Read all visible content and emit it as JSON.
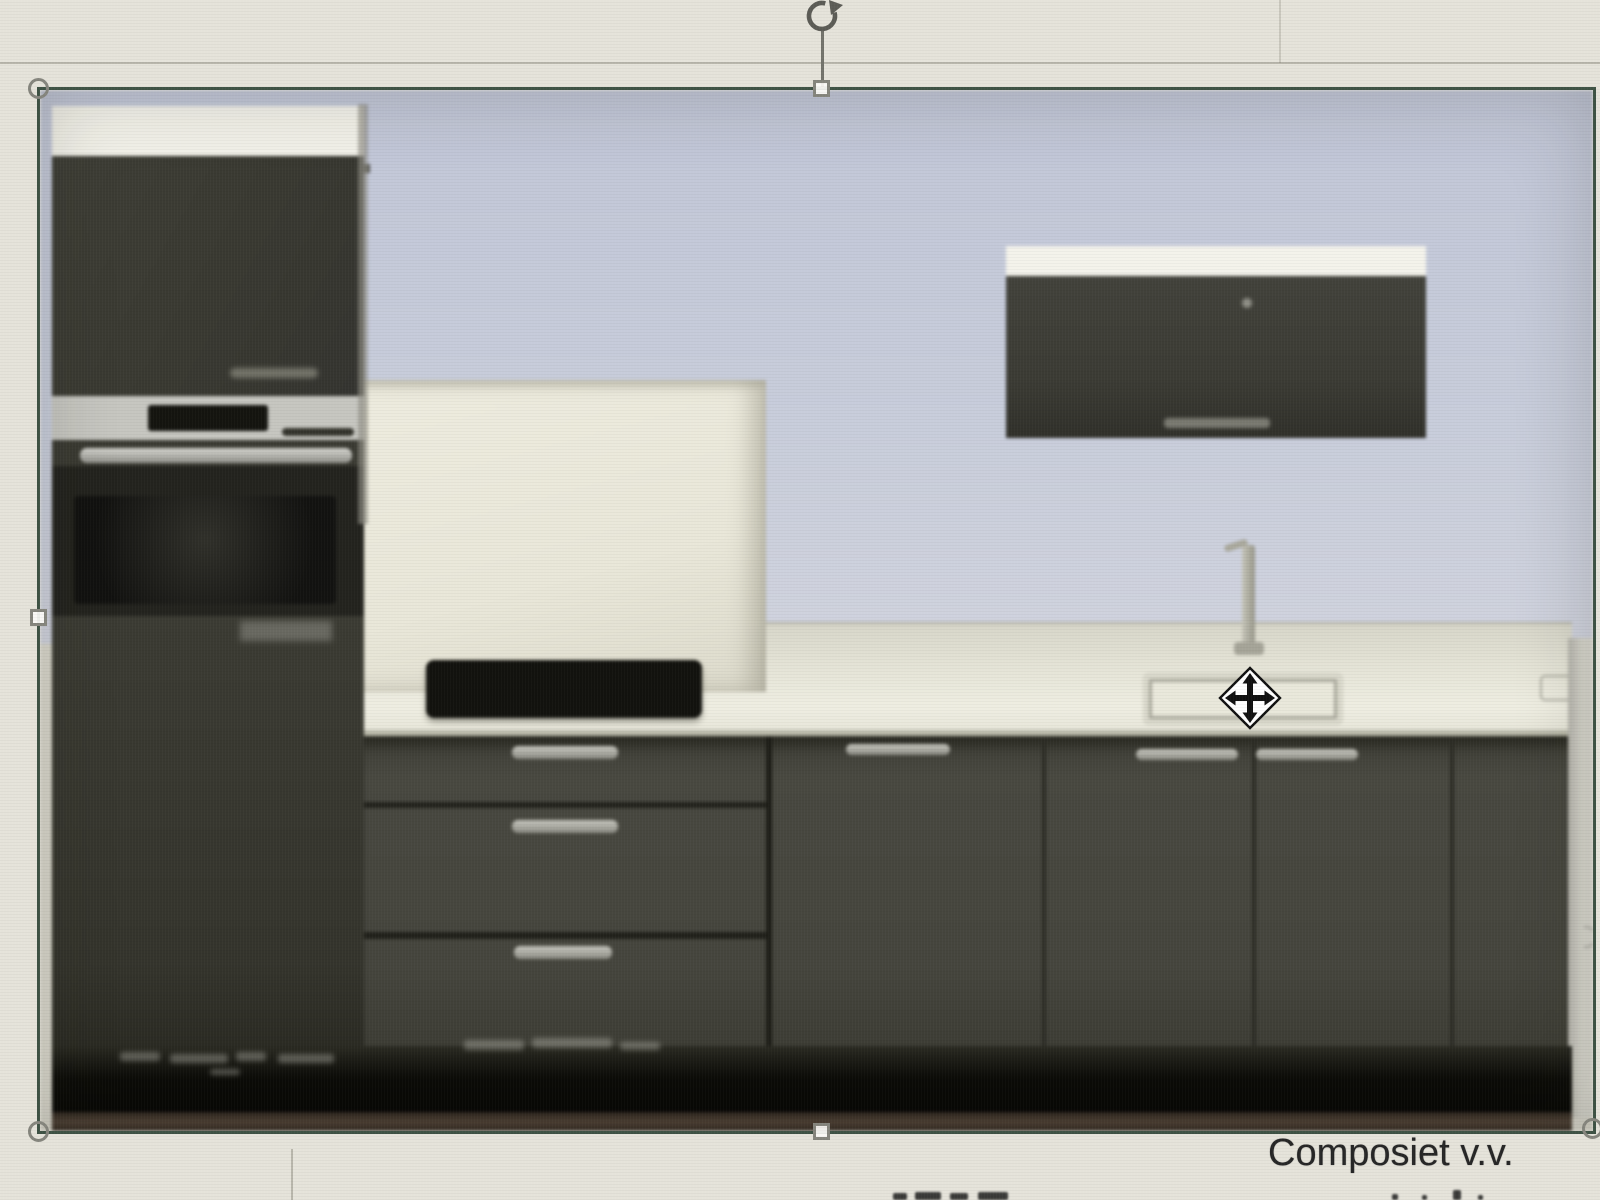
{
  "window": {
    "context": "presentation-editor slide area with a selected picture"
  },
  "slide": {
    "background_color": "#e5e3da",
    "caption_text": "Composiet v.v.",
    "caption_color": "#262626",
    "bottom_edge_fragments": "tops of cropped text characters at screen bottom edge"
  },
  "selected_image": {
    "type": "picture",
    "description": "Blurry product photo of a dark grey kitchen block: tall oven cabinet left, cream back panel with black hob niche, white worktop with sink and tap, dark base cabinets with drawers, dark wall cabinet upper right, black plinth with illegible spec text",
    "border_color": "#3e5244",
    "colors": {
      "wall": "#c6cbdb",
      "cabinets": "#41413a",
      "worktop": "#e9e8dc",
      "back_panel": "#edebdd",
      "plinth": "#0a0a08",
      "appliance_trim": "#c6c6c0"
    }
  },
  "selection": {
    "corner_handle_shape": "circle",
    "edge_handle_shape": "square",
    "handle_border_color": "#85857d",
    "handle_fill_color": "#fbfaf6",
    "visible_handles": [
      "top-left",
      "left-middle",
      "bottom-left",
      "top-middle",
      "bottom-middle",
      "bottom-right-partial"
    ],
    "rotation_handle": "clockwise circular arrow above top-middle handle"
  },
  "cursor": {
    "type": "move",
    "description": "black four-direction arrow inside white diamond",
    "arrow_color": "#111111",
    "diamond_fill": "#ffffff"
  },
  "guides": {
    "horizontal_top_guide_y": 62,
    "vertical_top_guide_x": 1279,
    "vertical_bottom_guide_x": 291
  }
}
